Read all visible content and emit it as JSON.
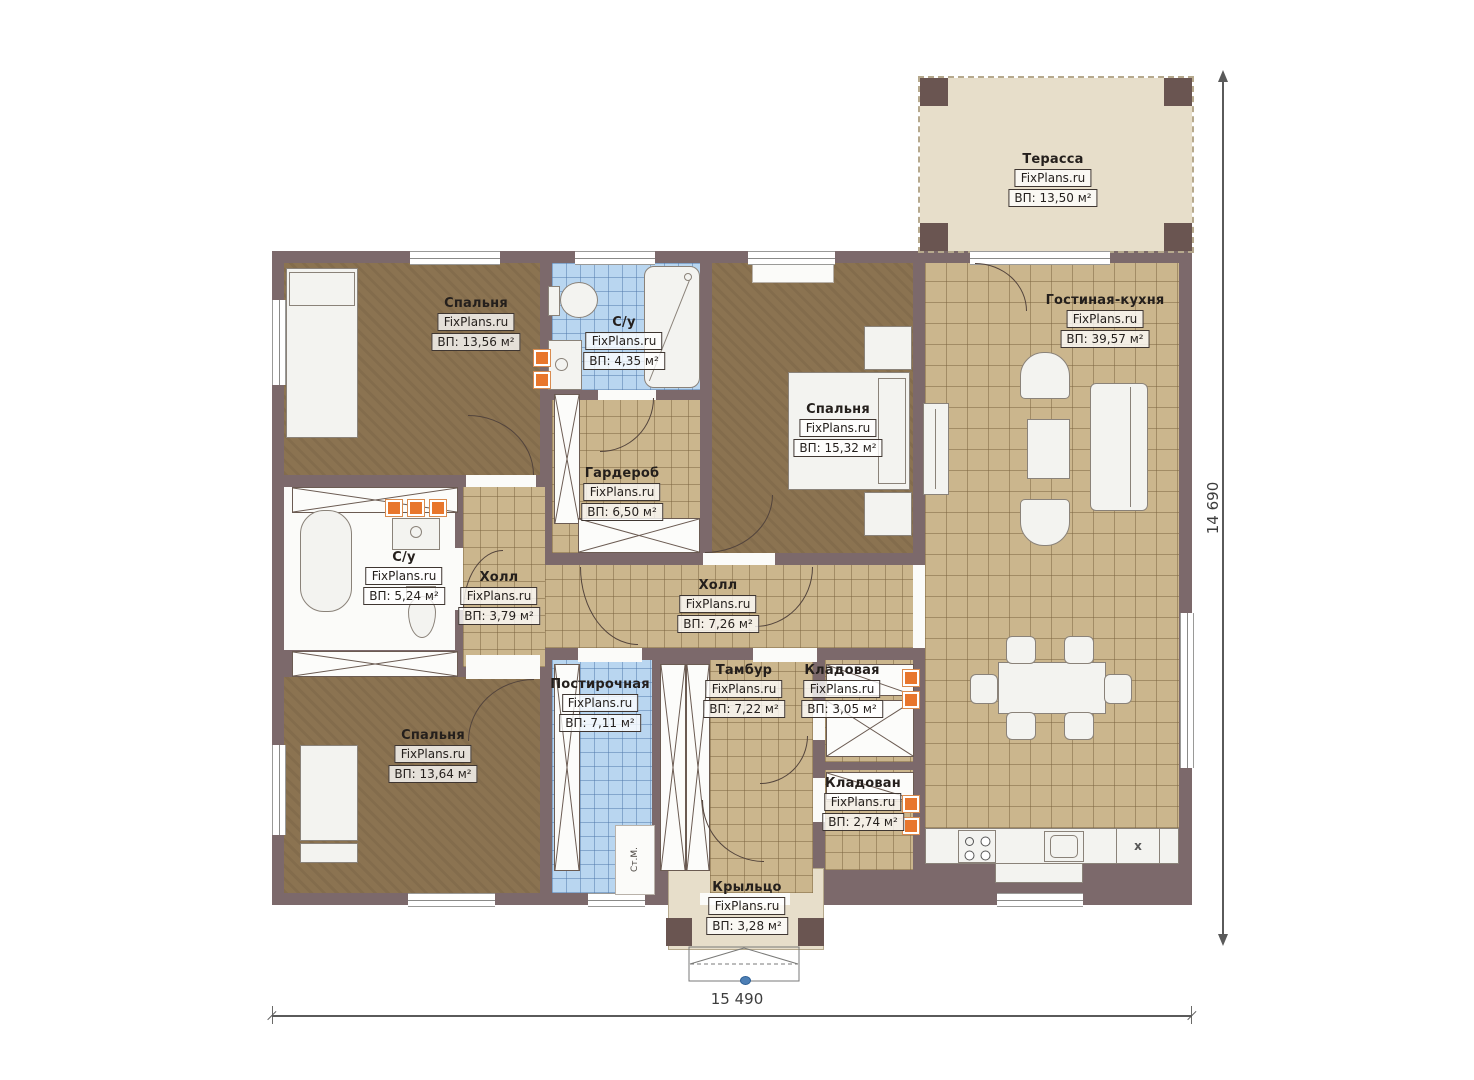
{
  "watermark": "FixPlans.ru",
  "rooms": {
    "terrace": {
      "name": "Терасса",
      "area": "ВП: 13,50 м²"
    },
    "bedroom_tl": {
      "name": "Спальня",
      "area": "ВП: 13,56 м²"
    },
    "bath_top": {
      "name": "С/у",
      "area": "ВП: 4,35 м²"
    },
    "living_kitchen": {
      "name": "Гостиная-кухня",
      "area": "ВП: 39,57 м²"
    },
    "bedroom_right": {
      "name": "Спальня",
      "area": "ВП: 15,32 м²"
    },
    "wardrobe": {
      "name": "Гардероб",
      "area": "ВП: 6,50 м²"
    },
    "bath_left": {
      "name": "С/у",
      "area": "ВП: 5,24 м²"
    },
    "hall_small": {
      "name": "Холл",
      "area": "ВП: 3,79 м²"
    },
    "hall_main": {
      "name": "Холл",
      "area": "ВП: 7,26 м²"
    },
    "bedroom_bl": {
      "name": "Спальня",
      "area": "ВП: 13,64 м²"
    },
    "laundry": {
      "name": "Постирочная",
      "area": "ВП: 7,11 м²"
    },
    "vestibule": {
      "name": "Тамбур",
      "area": "ВП: 7,22 м²"
    },
    "storage_1": {
      "name": "Кладовая",
      "area": "ВП: 3,05 м²"
    },
    "storage_2": {
      "name": "Кладован",
      "area": "ВП: 2,74 м²"
    },
    "porch": {
      "name": "Крыльцо",
      "area": "ВП: 3,28 м²"
    }
  },
  "dimensions": {
    "width": "15 490",
    "height": "14 690"
  },
  "annotations": {
    "washing_machine": "Ст.М.",
    "fridge": "x"
  },
  "colors": {
    "wall": "#7c696b",
    "tile_tan": "#cbb68d",
    "tile_blue": "#b9d6f0",
    "floor_brown": "#8b7351",
    "terrace": "#e7deca",
    "vent_orange": "#e8762c"
  }
}
